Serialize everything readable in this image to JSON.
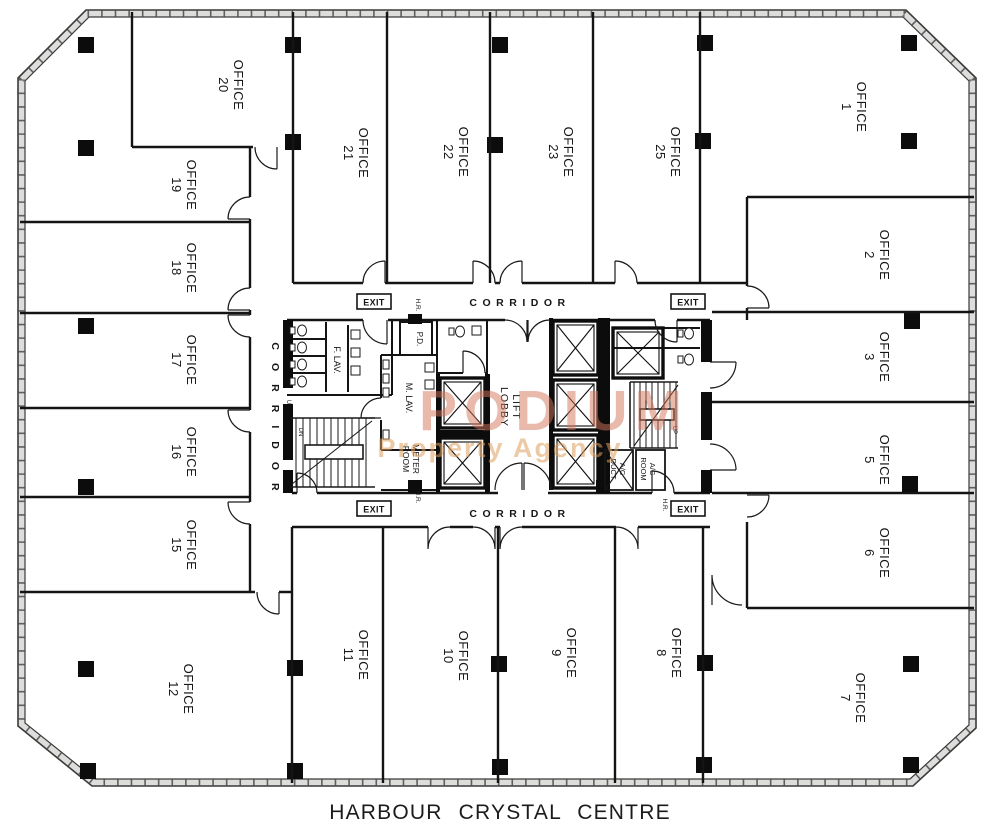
{
  "title": "HARBOUR CRYSTAL CENTRE",
  "watermark": {
    "line1": "PODIUM",
    "line2": "Property Agency"
  },
  "offices": [
    {
      "line1": "OFFICE",
      "line2": "20"
    },
    {
      "line1": "OFFICE",
      "line2": "19"
    },
    {
      "line1": "OFFICE",
      "line2": "18"
    },
    {
      "line1": "OFFICE",
      "line2": "17"
    },
    {
      "line1": "OFFICE",
      "line2": "16"
    },
    {
      "line1": "OFFICE",
      "line2": "15"
    },
    {
      "line1": "OFFICE",
      "line2": "12"
    },
    {
      "line1": "OFFICE",
      "line2": "21"
    },
    {
      "line1": "OFFICE",
      "line2": "22"
    },
    {
      "line1": "OFFICE",
      "line2": "23"
    },
    {
      "line1": "OFFICE",
      "line2": "25"
    },
    {
      "line1": "OFFICE",
      "line2": "1"
    },
    {
      "line1": "OFFICE",
      "line2": "2"
    },
    {
      "line1": "OFFICE",
      "line2": "3"
    },
    {
      "line1": "OFFICE",
      "line2": "5"
    },
    {
      "line1": "OFFICE",
      "line2": "6"
    },
    {
      "line1": "OFFICE",
      "line2": "7"
    },
    {
      "line1": "OFFICE",
      "line2": "11"
    },
    {
      "line1": "OFFICE",
      "line2": "10"
    },
    {
      "line1": "OFFICE",
      "line2": "9"
    },
    {
      "line1": "OFFICE",
      "line2": "8"
    }
  ],
  "rooms": {
    "f_lav": "F. LAV.",
    "m_lav": "M. LAV.",
    "pd": "P.D.",
    "meter_room": {
      "line1": "METER",
      "line2": "ROOM"
    },
    "lift_lobby": {
      "line1": "LIFT",
      "line2": "LOBBY"
    },
    "ac_duct": {
      "line1": "A/C",
      "line2": "DUCT"
    },
    "ac_room": {
      "line1": "A/C",
      "line2": "ROOM"
    }
  },
  "labels": {
    "corridor": "CORRIDOR",
    "exit": "EXIT",
    "hose_reel": "H.R.",
    "up": "UP",
    "dn": "DN"
  },
  "colors": {
    "ink": "#161616",
    "watermark_primary": "#d4765c",
    "watermark_secondary": "#dfa05e"
  }
}
